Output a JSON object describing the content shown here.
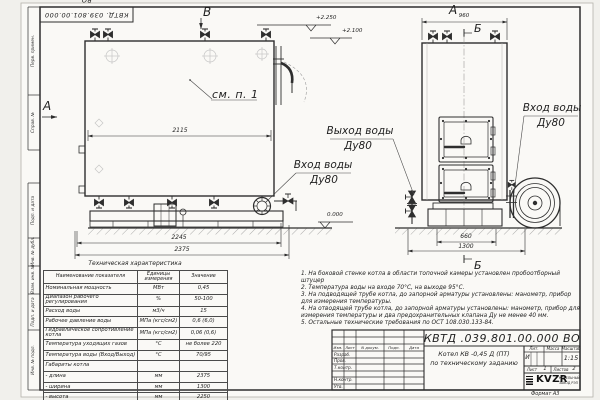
{
  "doc": {
    "number": "КВТД .039.801.00.000  ВО",
    "number_stamp": "КВТД. 039.801.00.000  ВО",
    "format": "Формат  А3"
  },
  "margin_labels": [
    "Перв. примен.",
    "Справ. №",
    "Подп. и дата",
    "Инв. № дубл.",
    "Взам. инв. №",
    "Подп. и дата",
    "Инв. № подл."
  ],
  "views": {
    "front_label": "В",
    "left_label": "А",
    "side_label": "А",
    "section_top": "Б",
    "section_bottom": "Б",
    "callout": "см. п. 1"
  },
  "elevations": {
    "top1": "+2.250",
    "top2": "+2.100",
    "zero": "0.000"
  },
  "dimensions": {
    "front_width": "2115",
    "front_skid": "2245",
    "front_total": "2375",
    "side_top": "960",
    "side_skid": "660",
    "side_total": "1300"
  },
  "pipes": {
    "outlet_line1": "Выход воды",
    "outlet_line2": "Ду80",
    "inlet_front_line1": "Вход воды",
    "inlet_front_line2": "Ду80",
    "inlet_side_line1": "Вход воды",
    "inlet_side_line2": "Ду80"
  },
  "spec_table": {
    "title": "Техническая характеристика",
    "headers": {
      "name": "Наименование показателя",
      "unit": "Единицы измерения",
      "value": "Значение"
    },
    "rows": [
      {
        "name": "Номинальная мощность",
        "unit": "МВт",
        "value": "0,45"
      },
      {
        "name": "Диапазон рабочего регулирования",
        "unit": "%",
        "value": "50-100"
      },
      {
        "name": "Расход воды",
        "unit": "м3/ч",
        "value": "15"
      },
      {
        "name": "Рабочее давление воды",
        "unit": "МПа (кгс/см2)",
        "value": "0,6 (6,0)"
      },
      {
        "name": "Гидравлическое сопротивление котла",
        "unit": "МПа (кгс/см2)",
        "value": "0,06 (0,6)"
      },
      {
        "name": "Температура уходящих газов",
        "unit": "°С",
        "value": "не более 220"
      },
      {
        "name": "Температура воды (Вход/Выход)",
        "unit": "°С",
        "value": "70/95"
      },
      {
        "name": "Габариты котла",
        "unit": "",
        "value": ""
      },
      {
        "name": "-  длина",
        "unit": "мм",
        "value": "2375"
      },
      {
        "name": "-  ширина",
        "unit": "мм",
        "value": "1300"
      },
      {
        "name": "-  высота",
        "unit": "мм",
        "value": "2250"
      }
    ]
  },
  "notes": [
    "1.  На боковой стенке котла в области топочной камеры установлен пробоотборный штуцер",
    "2.  Температура воды на входе 70°С, на выходе 95°С.",
    "3.  На подводящей трубе котла, до запорной арматуры установлены: манометр, прибор для измерения температуры.",
    "4.  На отводящей трубе котла, до запорной арматуры установлены: манометр, прибор для измерения температуры и два предохранительных клапана Ду не менее 40 мм.",
    "5.  Остальные технические требования по ОСТ 108.030.133-84."
  ],
  "title_block": {
    "doc_title_line1": "Котел  КВ -0,45  Д  (ПТ)",
    "doc_title_line2": "по техническому заданию",
    "cols": {
      "izm": "Изм.",
      "list": "Лист",
      "ndoc": "N докум.",
      "podp": "Подп.",
      "data": "Дата"
    },
    "rows": {
      "razrab": "Разраб.",
      "prov": "Пров.",
      "tkontr": "Т.контр.",
      "nkontr": "Н.контр.",
      "utv": "Утв."
    },
    "lit_label": "Лит.",
    "massa_label": "Масса",
    "masshtab_label": "Масштаб",
    "lit_value": "И",
    "masshtab_value": "1:15",
    "list_label": "Лист",
    "list_value": "1",
    "listov_label": "Листов",
    "listov_value": "2",
    "logo_text": "KVZR",
    "logo_sub1": "КОТЕЛЬНЫЙ",
    "logo_sub2": "ЗАВОД РЭП"
  }
}
